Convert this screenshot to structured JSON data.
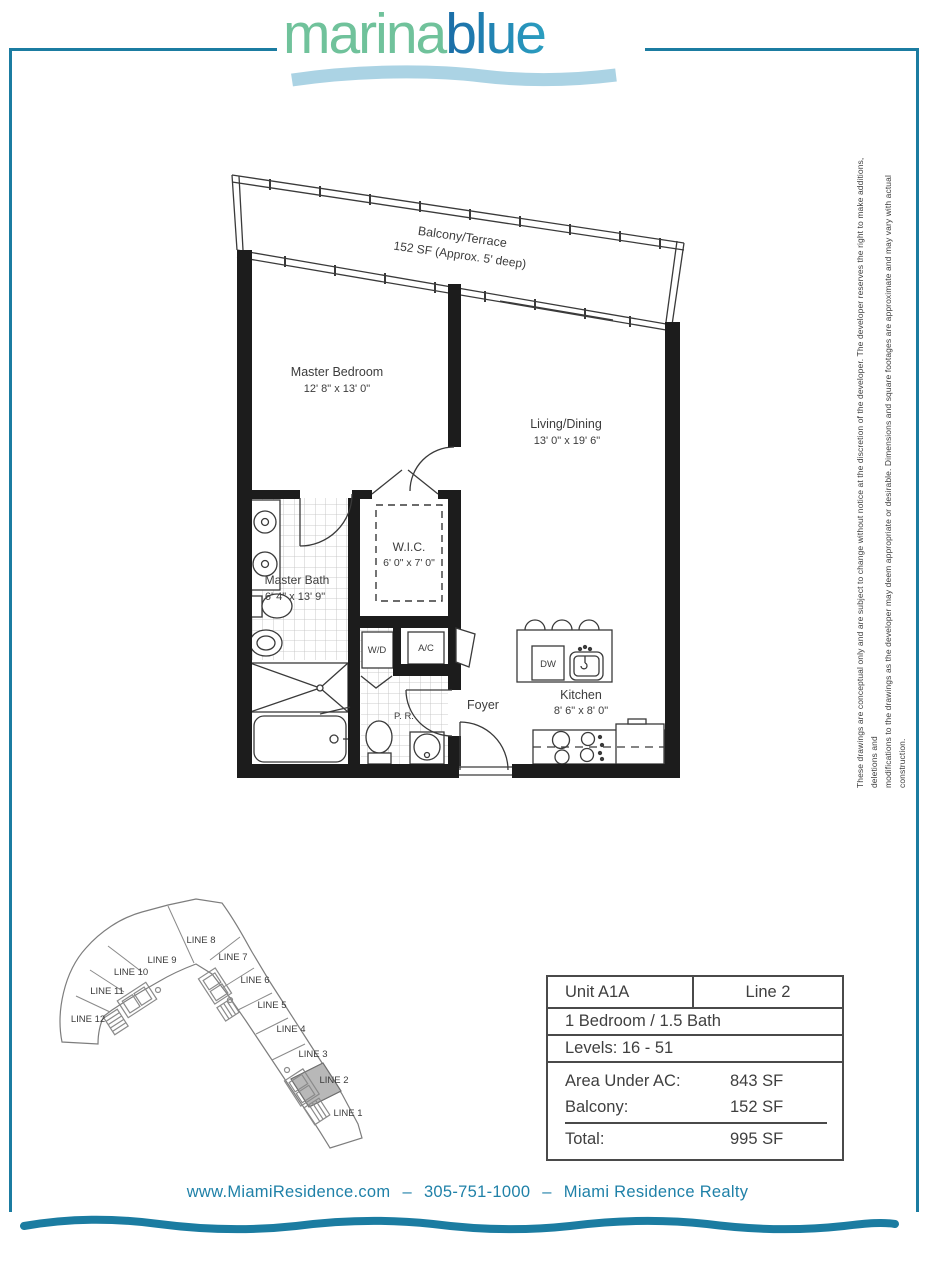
{
  "logo": {
    "part1": "marina",
    "part2": "blue"
  },
  "disclaimer": {
    "line1": "These drawings are conceptual only and are subject to change without notice at the discretion of the developer. The developer reserves the right to make additions, deletions and",
    "line2": "modifications to the drawings as the developer may deem appropriate or desirable. Dimensions and square footages are approximate and may vary with actual construction."
  },
  "floorplan": {
    "balcony_name": "Balcony/Terrace",
    "balcony_dims": "152 SF (Approx. 5' deep)",
    "master_bedroom_name": "Master Bedroom",
    "master_bedroom_dims": "12' 8\" x 13' 0\"",
    "living_name": "Living/Dining",
    "living_dims": "13' 0\" x 19' 6\"",
    "wic_name": "W.I.C.",
    "wic_dims": "6' 0\" x 7' 0\"",
    "bath_name": "Master Bath",
    "bath_dims": "6' 4\" x 13' 9\"",
    "kitchen_name": "Kitchen",
    "kitchen_dims": "8' 6\" x 8' 0\"",
    "foyer": "Foyer",
    "wd": "W/D",
    "ac": "A/C",
    "pr": "P. R.",
    "dw": "DW"
  },
  "siteplan": {
    "lines": [
      "LINE 1",
      "LINE 2",
      "LINE 3",
      "LINE 4",
      "LINE 5",
      "LINE 6",
      "LINE 7",
      "LINE 8",
      "LINE 9",
      "LINE 10",
      "LINE 11",
      "LINE 12"
    ],
    "highlighted": "LINE 2"
  },
  "unit_table": {
    "unit": "Unit A1A",
    "line": "Line 2",
    "bed_bath": "1 Bedroom / 1.5 Bath",
    "levels": "Levels: 16 - 51",
    "rows": [
      {
        "label": "Area Under AC:",
        "value": "843 SF"
      },
      {
        "label": "Balcony:",
        "value": "152 SF"
      },
      {
        "label": "Total:",
        "value": "995 SF"
      }
    ]
  },
  "footer": {
    "website": "www.MiamiResidence.com",
    "separator": "–",
    "phone": "305-751-1000",
    "company": "Miami Residence Realty"
  },
  "colors": {
    "accent": "#1b7ca1",
    "logo_green": "#70c29b",
    "logo_blue": "#1d74a9",
    "underline_wave": "#abd3e4",
    "line2_fill": "#b8b8b8"
  }
}
